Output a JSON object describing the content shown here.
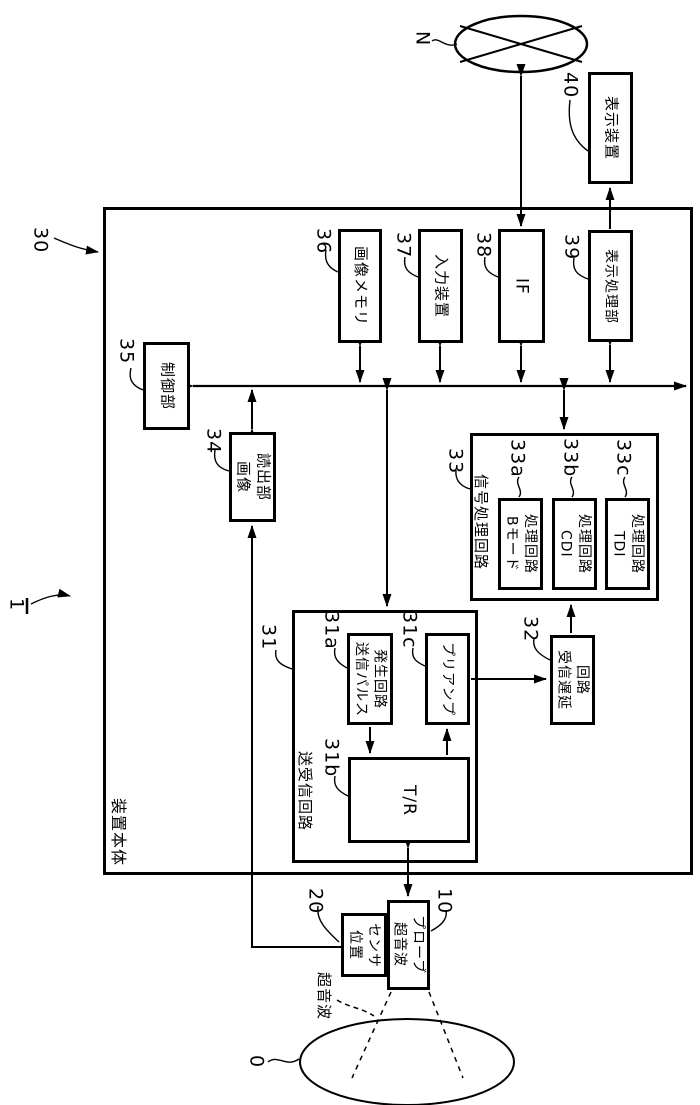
{
  "boxes": {
    "main_body": {
      "num": "30",
      "text": "装置本体"
    },
    "display_device": {
      "num": "40",
      "text": "表示装置"
    },
    "control_unit": {
      "num": "35",
      "text": "制御部"
    },
    "image_memory": {
      "num": "36",
      "text": "画像メモリ"
    },
    "input_device": {
      "num": "37",
      "text": "入力装置"
    },
    "interface": {
      "num": "38",
      "text": "IF"
    },
    "display_processing": {
      "num": "39",
      "text": "表示処理部"
    },
    "image_readout": {
      "num": "34",
      "text": "画像\n読出部"
    },
    "signal_processing": {
      "num": "33",
      "text": "信号処理回路"
    },
    "b_mode_circuit": {
      "num": "33a",
      "text": "Bモード\n処理回路"
    },
    "cdi_circuit": {
      "num": "33b",
      "text": "CDI\n処理回路"
    },
    "tdi_circuit": {
      "num": "33c",
      "text": "TDI\n処理回路"
    },
    "tx_rx_circuit": {
      "num": "31",
      "text": "送受信回路"
    },
    "tx_pulse_gen": {
      "num": "31a",
      "text": "送信パルス\n発生回路"
    },
    "t_r_switch": {
      "num": "31b",
      "text": "T/R"
    },
    "preamp": {
      "num": "31c",
      "text": "プリアンプ"
    },
    "rx_delay": {
      "num": "32",
      "text": "受信遅延\n回路"
    },
    "probe": {
      "num": "10",
      "text": "超音波\nプローブ"
    },
    "position_sensor": {
      "num": "20",
      "text": "位置\nセンサ"
    }
  },
  "annotations": {
    "system_num": "1",
    "network_label": "N",
    "subject_num": "0",
    "ultrasound_beam": "超音波"
  }
}
